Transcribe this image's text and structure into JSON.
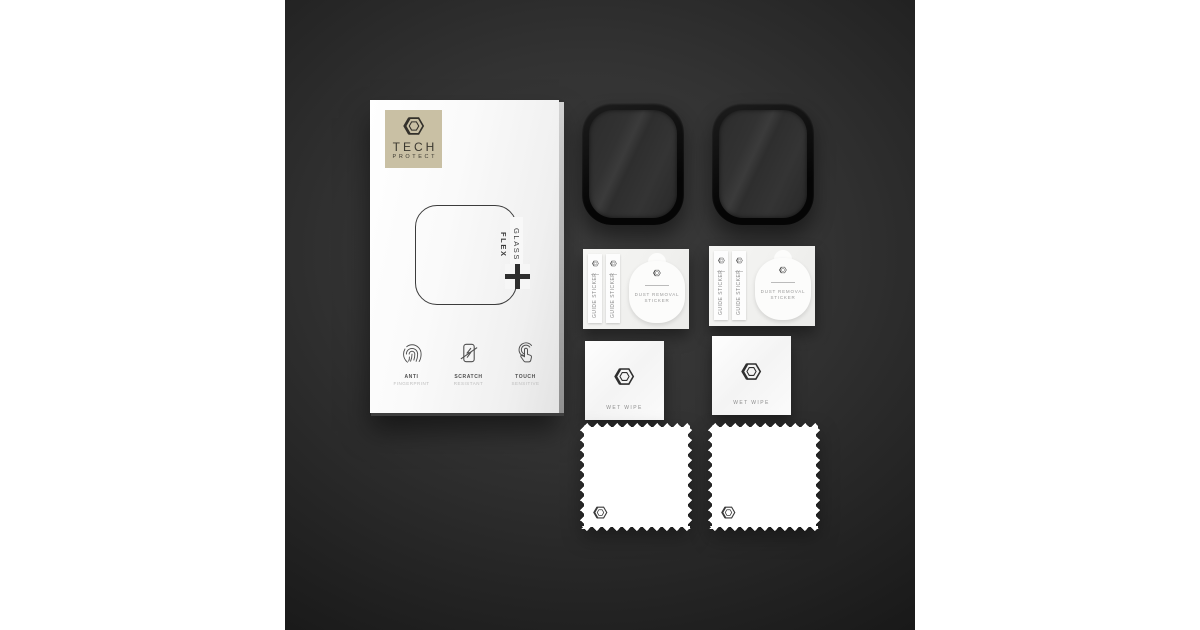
{
  "brand": {
    "name_line1": "TECH",
    "name_line2": "PROTECT"
  },
  "box": {
    "product_glass": "GLASS",
    "product_flex": "FLEX",
    "product_plus": "+",
    "features": [
      {
        "icon": "anti-fingerprint-icon",
        "title": "ANTI",
        "subtitle": "FINGERPRINT"
      },
      {
        "icon": "scratch-resistant-icon",
        "title": "SCRATCH",
        "subtitle": "RESISTANT"
      },
      {
        "icon": "touch-sensitive-icon",
        "title": "TOUCH",
        "subtitle": "SENSITIVE"
      }
    ]
  },
  "kit": {
    "protectors_count": 2,
    "sets_count": 2,
    "guide_strip": {
      "label": "GUIDE STICKER"
    },
    "dust_sticker": {
      "line1": "DUST REMOVAL",
      "line2": "STICKER"
    },
    "wet_wipe": {
      "label": "WET WIPE"
    }
  },
  "colors": {
    "page_bg": "#ffffff",
    "photo_bg_center": "#3b3b3b",
    "photo_bg_edge": "#161616",
    "brand_label_bg": "#c9c0a4",
    "box_face": "#fafafa",
    "protector_frame": "#0a0a0a",
    "protector_glass": "#303030",
    "accessory_white": "#fcfcfb"
  }
}
